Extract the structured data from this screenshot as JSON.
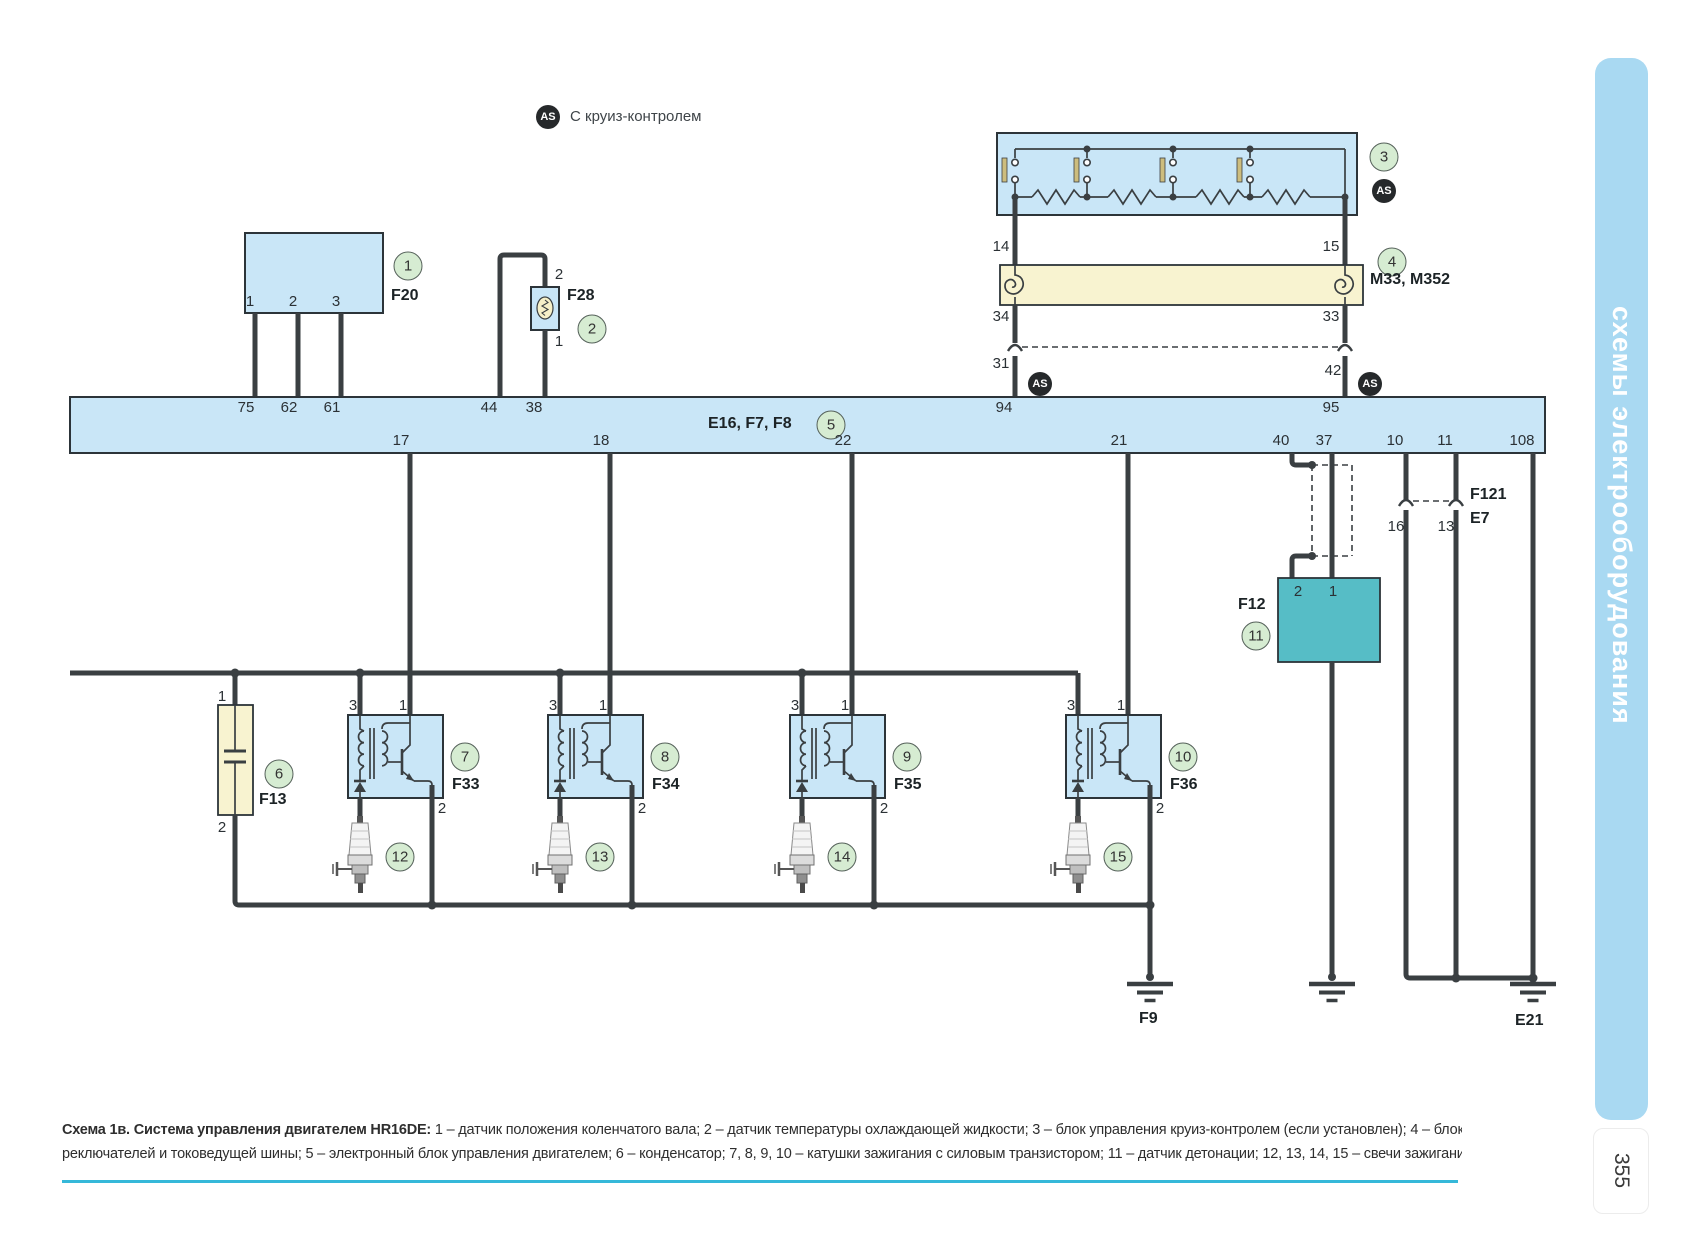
{
  "legend": {
    "badge": "AS",
    "text": "С круиз-контролем"
  },
  "cruise": {
    "num": "3",
    "badge": "AS",
    "pin14": "14",
    "pin15": "15"
  },
  "holder": {
    "num": "4",
    "name": "M33, M352",
    "pin34": "34",
    "pin33": "33",
    "pin31": "31",
    "pin42": "42",
    "badge": "AS"
  },
  "crank": {
    "num": "1",
    "name": "F20",
    "pins": [
      "1",
      "2",
      "3"
    ]
  },
  "coolant": {
    "num": "2",
    "name": "F28",
    "pin_top": "2",
    "pin_bottom": "1"
  },
  "ecu": {
    "num": "5",
    "name": "E16, F7, F8",
    "top_pins": [
      "75",
      "62",
      "61",
      "44",
      "38",
      "94",
      "95"
    ],
    "bottom_pins": [
      "17",
      "18",
      "22",
      "21",
      "40",
      "37",
      "10",
      "11",
      "108"
    ]
  },
  "cap": {
    "num": "6",
    "name": "F13",
    "pin_top": "1",
    "pin_bottom": "2"
  },
  "coils": [
    {
      "num": "7",
      "name": "F33",
      "p3": "3",
      "p1": "1",
      "p2": "2"
    },
    {
      "num": "8",
      "name": "F34",
      "p3": "3",
      "p1": "1",
      "p2": "2"
    },
    {
      "num": "9",
      "name": "F35",
      "p3": "3",
      "p1": "1",
      "p2": "2"
    },
    {
      "num": "10",
      "name": "F36",
      "p3": "3",
      "p1": "1",
      "p2": "2"
    }
  ],
  "plugs": [
    {
      "num": "12"
    },
    {
      "num": "13"
    },
    {
      "num": "14"
    },
    {
      "num": "15"
    }
  ],
  "knock": {
    "num": "11",
    "name": "F12",
    "pin2": "2",
    "pin1": "1"
  },
  "conn": {
    "name1": "F121",
    "name2": "E7",
    "pin16": "16",
    "pin13": "13"
  },
  "grounds": {
    "f9": "F9",
    "e21": "E21"
  },
  "sidebar": {
    "text": "схемы электрооборудования",
    "page": "355"
  },
  "caption": {
    "intro": "Схема 1в. Система управления двигателем HR16DE:",
    "line1_rest": " 1 – датчик положения коленчатого вала; 2 – датчик температуры охлаждающей жидкости; 3 – блок управления круиз-контролем (если установлен); 4 – блок держателя подрулевых пе-",
    "line2": "реключателей и токоведущей шины; 5 – электронный блок управления двигателем; 6  – конденсатор; 7, 8, 9, 10 – катушки зажигания с силовым транзистором; 11 – датчик детонации; 12, 13, 14, 15 – свечи зажигания"
  },
  "colors": {
    "wire": "#3a3f42",
    "block_blue": "#c9e6f7",
    "block_yellow": "#f8f3d0",
    "knock_teal": "#56bdc6",
    "rule_cyan": "#35b8d9",
    "sidebar_blue": "#a9d9f2",
    "callout_green": "#d6ecd2",
    "badge_black": "#26292b"
  }
}
